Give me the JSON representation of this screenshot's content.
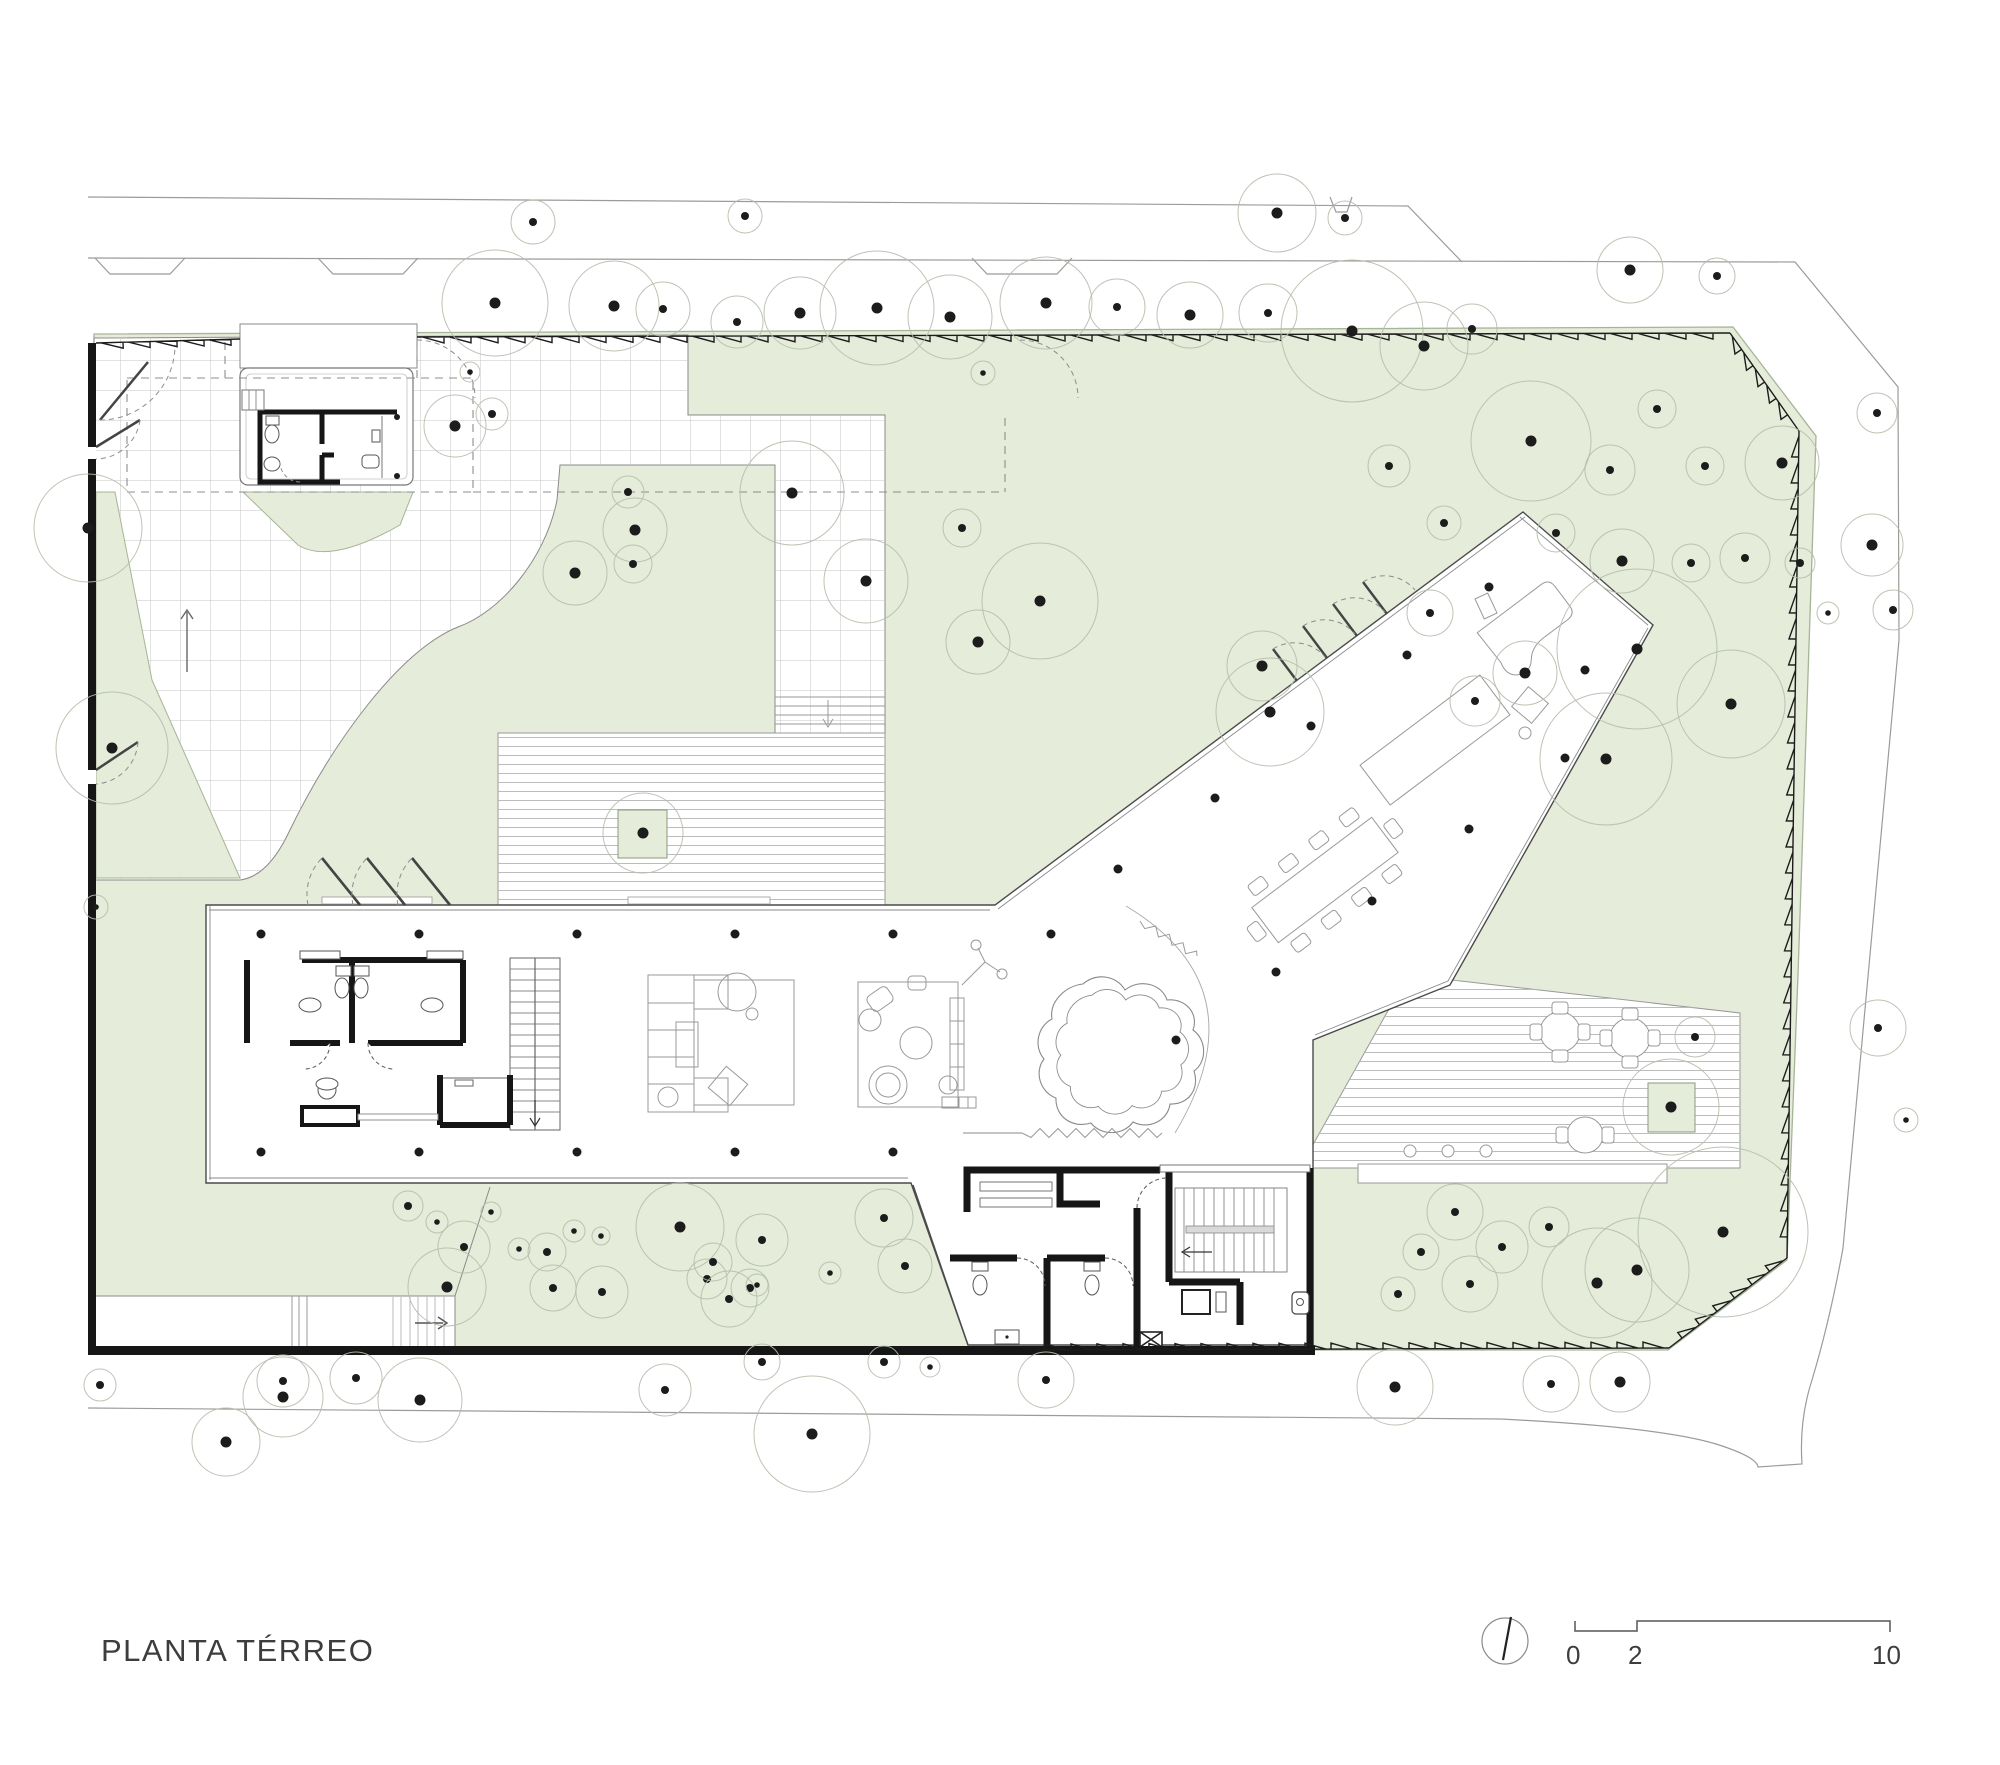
{
  "title": "PLANTA TÉRREO",
  "scale_bar": {
    "labels": [
      "0",
      "2",
      "10"
    ]
  },
  "icons": {
    "north": "north-arrow-icon"
  },
  "colors": {
    "site_green": "#e5ecd9",
    "green_border": "#a6b497",
    "wall_black": "#161616",
    "thin_line": "#555555",
    "street_line": "#9b9b9b",
    "tree_stroke": "#b5beac",
    "tree_dot": "#1c1c1c",
    "tile_grid": "#c4c4c4",
    "deck_stripe": "#bcbcbc",
    "dash_line": "#8d8d8d"
  },
  "plan": {
    "trees": [
      [
        533,
        222,
        22
      ],
      [
        745,
        216,
        17
      ],
      [
        1277,
        213,
        39
      ],
      [
        1345,
        218,
        17
      ],
      [
        1630,
        270,
        33
      ],
      [
        1717,
        276,
        18
      ],
      [
        1877,
        413,
        20
      ],
      [
        1872,
        545,
        31
      ],
      [
        495,
        303,
        53
      ],
      [
        614,
        306,
        45
      ],
      [
        663,
        309,
        27
      ],
      [
        737,
        322,
        26
      ],
      [
        800,
        313,
        36
      ],
      [
        877,
        308,
        57
      ],
      [
        950,
        317,
        42
      ],
      [
        1046,
        303,
        46
      ],
      [
        1117,
        307,
        28
      ],
      [
        1190,
        315,
        33
      ],
      [
        1268,
        313,
        29
      ],
      [
        1352,
        331,
        71
      ],
      [
        1424,
        346,
        44
      ],
      [
        1472,
        329,
        25
      ],
      [
        1531,
        441,
        60
      ],
      [
        1610,
        470,
        25
      ],
      [
        1657,
        409,
        19
      ],
      [
        1705,
        466,
        19
      ],
      [
        1782,
        463,
        37
      ],
      [
        1637,
        649,
        80
      ],
      [
        1731,
        704,
        54
      ],
      [
        1606,
        759,
        66
      ],
      [
        1525,
        673,
        32
      ],
      [
        1475,
        701,
        25
      ],
      [
        1430,
        613,
        23
      ],
      [
        1389,
        466,
        21
      ],
      [
        1444,
        523,
        17
      ],
      [
        1556,
        533,
        19
      ],
      [
        1622,
        561,
        32
      ],
      [
        1691,
        563,
        19
      ],
      [
        1745,
        558,
        25
      ],
      [
        1800,
        563,
        15
      ],
      [
        1828,
        613,
        11
      ],
      [
        792,
        493,
        52
      ],
      [
        866,
        581,
        42
      ],
      [
        962,
        528,
        19
      ],
      [
        1040,
        601,
        58
      ],
      [
        978,
        642,
        32
      ],
      [
        983,
        373,
        12
      ],
      [
        628,
        492,
        16
      ],
      [
        635,
        530,
        32
      ],
      [
        575,
        573,
        32
      ],
      [
        633,
        564,
        19
      ],
      [
        455,
        426,
        31
      ],
      [
        492,
        414,
        16
      ],
      [
        470,
        372,
        10
      ],
      [
        88,
        528,
        54
      ],
      [
        112,
        748,
        56
      ],
      [
        96,
        907,
        12
      ],
      [
        1262,
        666,
        35
      ],
      [
        1270,
        712,
        54
      ],
      [
        643,
        833,
        40
      ],
      [
        1671,
        1107,
        48
      ],
      [
        762,
        1240,
        26
      ],
      [
        884,
        1218,
        29
      ],
      [
        905,
        1266,
        27
      ],
      [
        707,
        1279,
        20
      ],
      [
        750,
        1288,
        19
      ],
      [
        408,
        1206,
        15
      ],
      [
        437,
        1222,
        11
      ],
      [
        464,
        1247,
        26
      ],
      [
        491,
        1212,
        10
      ],
      [
        519,
        1249,
        11
      ],
      [
        547,
        1252,
        19
      ],
      [
        574,
        1231,
        11
      ],
      [
        601,
        1236,
        9
      ],
      [
        447,
        1287,
        39
      ],
      [
        553,
        1288,
        23
      ],
      [
        602,
        1292,
        26
      ],
      [
        680,
        1227,
        44
      ],
      [
        713,
        1262,
        19
      ],
      [
        757,
        1285,
        11
      ],
      [
        830,
        1273,
        11
      ],
      [
        729,
        1299,
        28
      ],
      [
        1455,
        1212,
        28
      ],
      [
        1502,
        1247,
        26
      ],
      [
        1549,
        1227,
        20
      ],
      [
        1421,
        1252,
        18
      ],
      [
        1398,
        1294,
        17
      ],
      [
        1470,
        1284,
        28
      ],
      [
        1597,
        1283,
        55
      ],
      [
        1637,
        1270,
        52
      ],
      [
        1723,
        1232,
        85
      ],
      [
        1695,
        1037,
        20
      ],
      [
        100,
        1385,
        16
      ],
      [
        283,
        1381,
        26
      ],
      [
        283,
        1397,
        40
      ],
      [
        356,
        1378,
        26
      ],
      [
        420,
        1400,
        42
      ],
      [
        226,
        1442,
        34
      ],
      [
        665,
        1390,
        26
      ],
      [
        762,
        1362,
        18
      ],
      [
        884,
        1362,
        16
      ],
      [
        1046,
        1380,
        28
      ],
      [
        812,
        1434,
        58
      ],
      [
        930,
        1367,
        10
      ],
      [
        1395,
        1387,
        38
      ],
      [
        1551,
        1384,
        28
      ],
      [
        1620,
        1382,
        30
      ],
      [
        1893,
        610,
        20
      ],
      [
        1878,
        1028,
        28
      ],
      [
        1906,
        1120,
        12
      ]
    ],
    "columns": [
      [
        261,
        934
      ],
      [
        419,
        934
      ],
      [
        577,
        934
      ],
      [
        735,
        934
      ],
      [
        893,
        934
      ],
      [
        1051,
        934
      ],
      [
        261,
        1152
      ],
      [
        419,
        1152
      ],
      [
        577,
        1152
      ],
      [
        735,
        1152
      ],
      [
        893,
        1152
      ],
      [
        1118,
        869
      ],
      [
        1215,
        798
      ],
      [
        1311,
        726
      ],
      [
        1407,
        655
      ],
      [
        1489,
        587
      ],
      [
        1276,
        972
      ],
      [
        1372,
        901
      ],
      [
        1469,
        829
      ],
      [
        1565,
        758
      ],
      [
        1585,
        670
      ],
      [
        1176,
        1040
      ]
    ],
    "small_columns": [
      [
        397,
        417
      ],
      [
        397,
        476
      ]
    ],
    "fence": [
      [
        96,
        343,
        240,
        339,
        27,
        6
      ],
      [
        417,
        337,
        1730,
        333,
        27,
        6
      ],
      [
        1730,
        333,
        1799,
        431,
        20,
        8
      ],
      [
        1799,
        431,
        1787,
        1258,
        26,
        7
      ],
      [
        1787,
        1258,
        1669,
        1348,
        22,
        7
      ],
      [
        1669,
        1348,
        1038,
        1350,
        26,
        6
      ]
    ],
    "zigzags": [
      [
        1022,
        1133,
        1162,
        1133,
        9,
        9
      ],
      [
        1140,
        921,
        1197,
        956,
        8,
        8
      ]
    ]
  }
}
